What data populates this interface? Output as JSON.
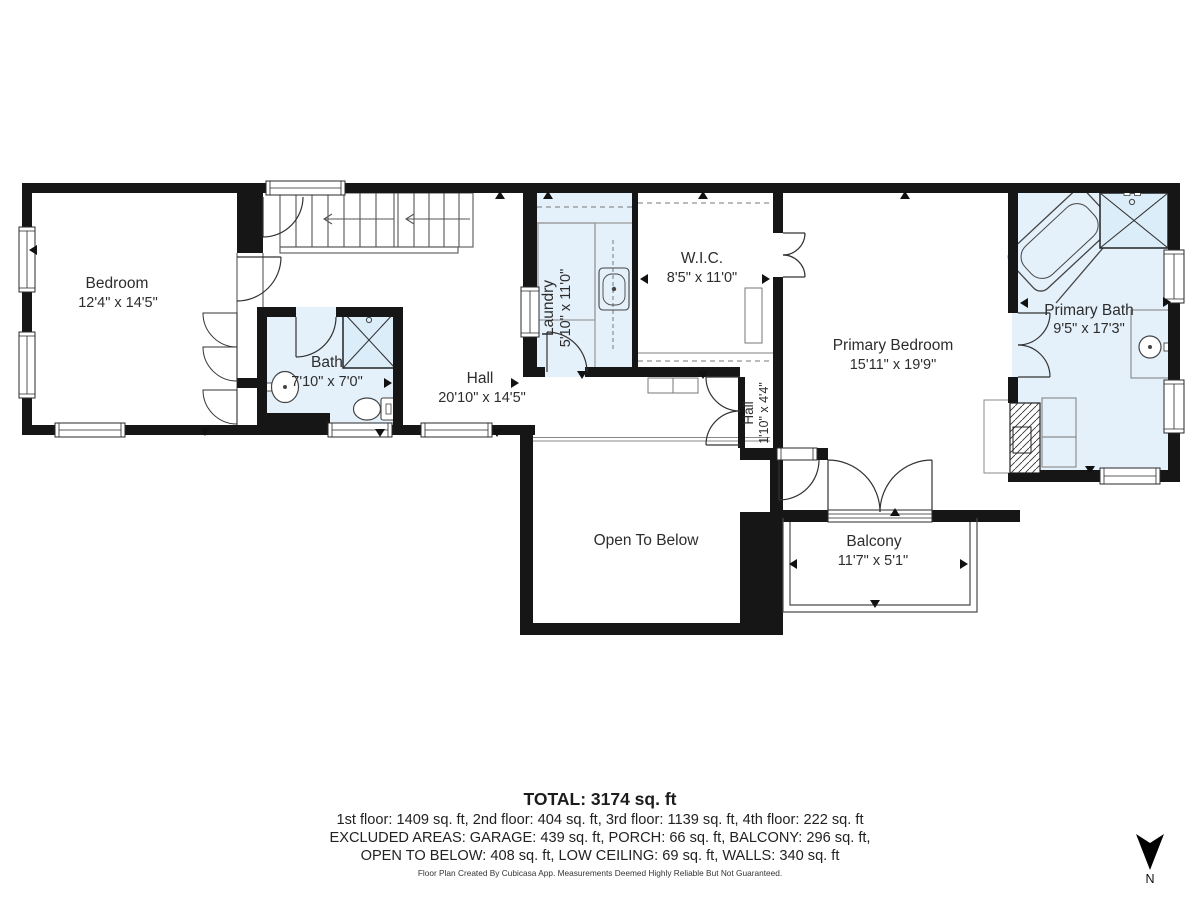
{
  "rooms": {
    "bedroom": {
      "name": "Bedroom",
      "dims": "12'4\" x 14'5\""
    },
    "bath": {
      "name": "Bath",
      "dims": "7'10\" x 7'0\""
    },
    "hall": {
      "name": "Hall",
      "dims": "20'10\" x 14'5\""
    },
    "laundry": {
      "name": "Laundry",
      "dims": "5'10\" x 11'0\""
    },
    "wic": {
      "name": "W.I.C.",
      "dims": "8'5\" x 11'0\""
    },
    "hall_small": {
      "name": "Hall",
      "dims": "1'10\" x 4'4\""
    },
    "primary_bedroom": {
      "name": "Primary Bedroom",
      "dims": "15'11\" x 19'9\""
    },
    "primary_bath": {
      "name": "Primary Bath",
      "dims": "9'5\" x 17'3\""
    },
    "open_to_below": {
      "name": "Open To Below"
    },
    "balcony": {
      "name": "Balcony",
      "dims": "11'7\" x 5'1\""
    }
  },
  "footer": {
    "total": "TOTAL: 3174 sq. ft",
    "line1": "1st floor: 1409 sq. ft, 2nd floor: 404 sq. ft, 3rd floor: 1139 sq. ft, 4th floor: 222 sq. ft",
    "line2": "EXCLUDED AREAS: GARAGE: 439 sq. ft, PORCH: 66 sq. ft, BALCONY: 296 sq. ft,",
    "line3": "OPEN TO BELOW: 408 sq. ft, LOW CEILING: 69 sq. ft, WALLS: 340 sq. ft",
    "disclaimer": "Floor Plan Created By Cubicasa App. Measurements Deemed Highly Reliable But Not Guaranteed."
  },
  "compass": {
    "label": "N"
  },
  "colors": {
    "wall": "#161616",
    "wet_room": "#e4f0fa",
    "line": "#555555"
  }
}
